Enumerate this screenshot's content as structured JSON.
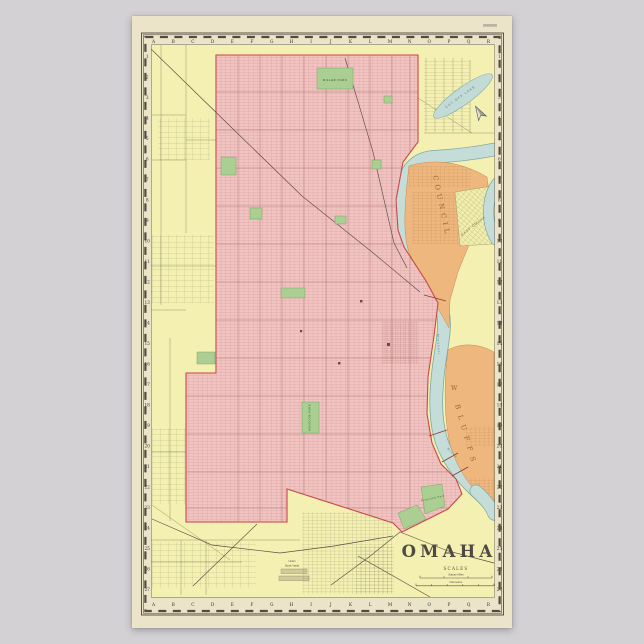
{
  "poster": {
    "map_title": "OMAHA",
    "scales": {
      "heading": "SCALES",
      "bars": [
        {
          "label": "Statute Miles"
        },
        {
          "label": "Kilometres"
        }
      ]
    },
    "grid": {
      "column_letters": [
        "A",
        "B",
        "C",
        "D",
        "E",
        "F",
        "G",
        "H",
        "I",
        "J",
        "K",
        "L",
        "M",
        "N",
        "O",
        "P",
        "Q",
        "R"
      ],
      "row_numbers": [
        "1",
        "2",
        "3",
        "4",
        "5",
        "6",
        "7",
        "8",
        "9",
        "10",
        "11",
        "12",
        "13",
        "14",
        "15",
        "16",
        "17",
        "18",
        "19",
        "20",
        "21",
        "22",
        "23",
        "24",
        "25",
        "26",
        "27"
      ]
    },
    "regions": {
      "council_bluffs_upper": "COUNCIL",
      "council_bluffs_lower": "BLUFFS",
      "council_bluffs_w": "W",
      "east_omaha": "EAST OMAHA",
      "stockyards_line1": "Union",
      "stockyards_line2": "Stock Yards"
    },
    "water": {
      "lake": "CUT OFF LAKE",
      "river_word1": "Missouri",
      "river_word2": "River"
    },
    "parks": {
      "miller": "MILLER PARK",
      "hanscom": "HANSCOM PARK",
      "riverview": "Riverview Park"
    },
    "colors": {
      "city_pink": "#f1c3c1",
      "boundary_red": "#c94545",
      "suburb_yellow": "#f4f0b2",
      "bluffs_orange": "#eeb77e",
      "river_blue": "#c5ddd8",
      "park_green": "#abcf92",
      "paper_cream": "#ece4c9",
      "backdrop_gray": "#d3d1d4"
    }
  }
}
